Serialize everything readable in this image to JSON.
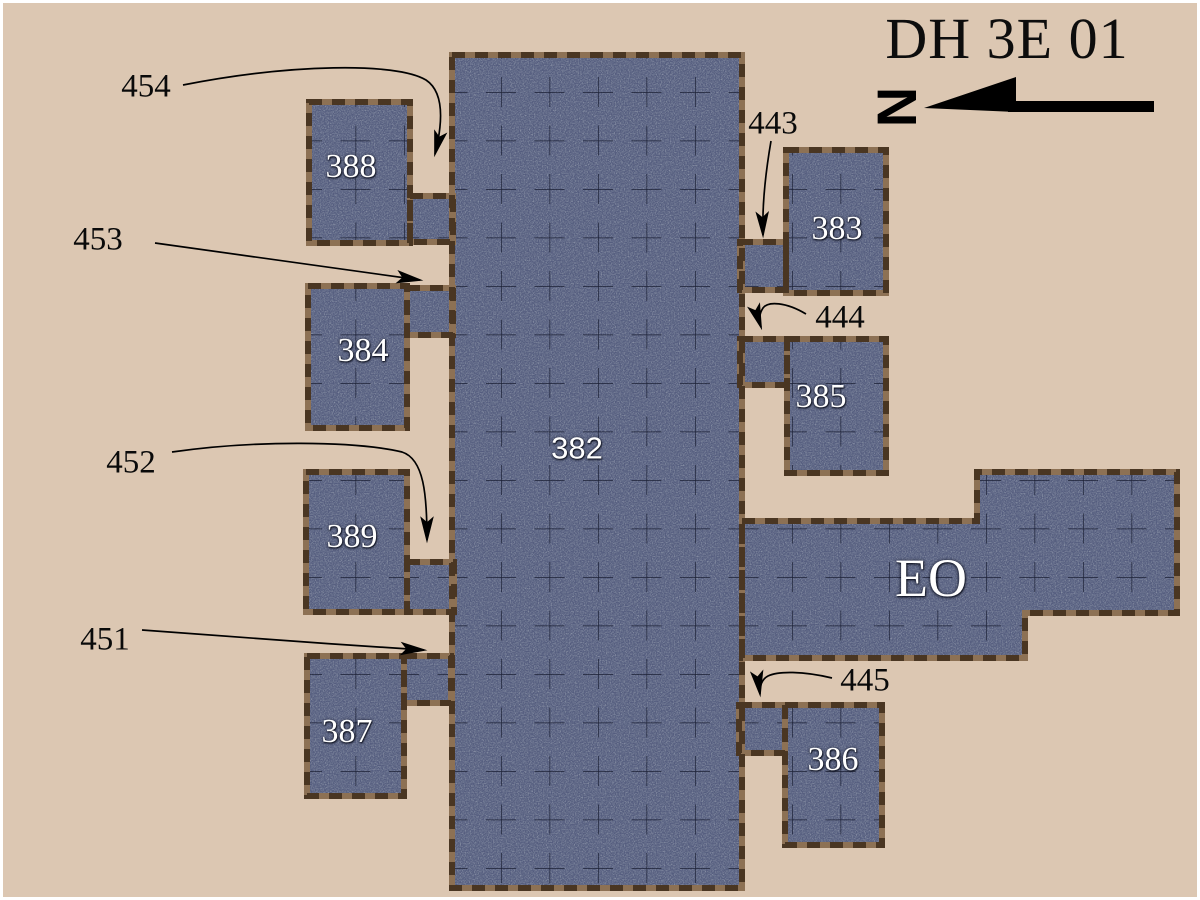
{
  "title": "DH 3E 01",
  "compass": {
    "letter": "N"
  },
  "rooms": {
    "r382": "382",
    "r383": "383",
    "r384": "384",
    "r385": "385",
    "r386": "386",
    "r387": "387",
    "r388": "388",
    "r389": "389",
    "eo": "EO"
  },
  "annotations": {
    "a443": "443",
    "a444": "444",
    "a445": "445",
    "a451": "451",
    "a452": "452",
    "a453": "453",
    "a454": "454"
  },
  "colors": {
    "background": "#dcc7b2",
    "room_fill": "#98a0b1",
    "room_speckle": "#172036",
    "room_border_dark": "#4a3622",
    "room_border_light": "#8d7154",
    "grid_line": "#151a2e",
    "room_number_text": "#ffffff",
    "ink": "#000000",
    "frame": "#ffffff"
  }
}
